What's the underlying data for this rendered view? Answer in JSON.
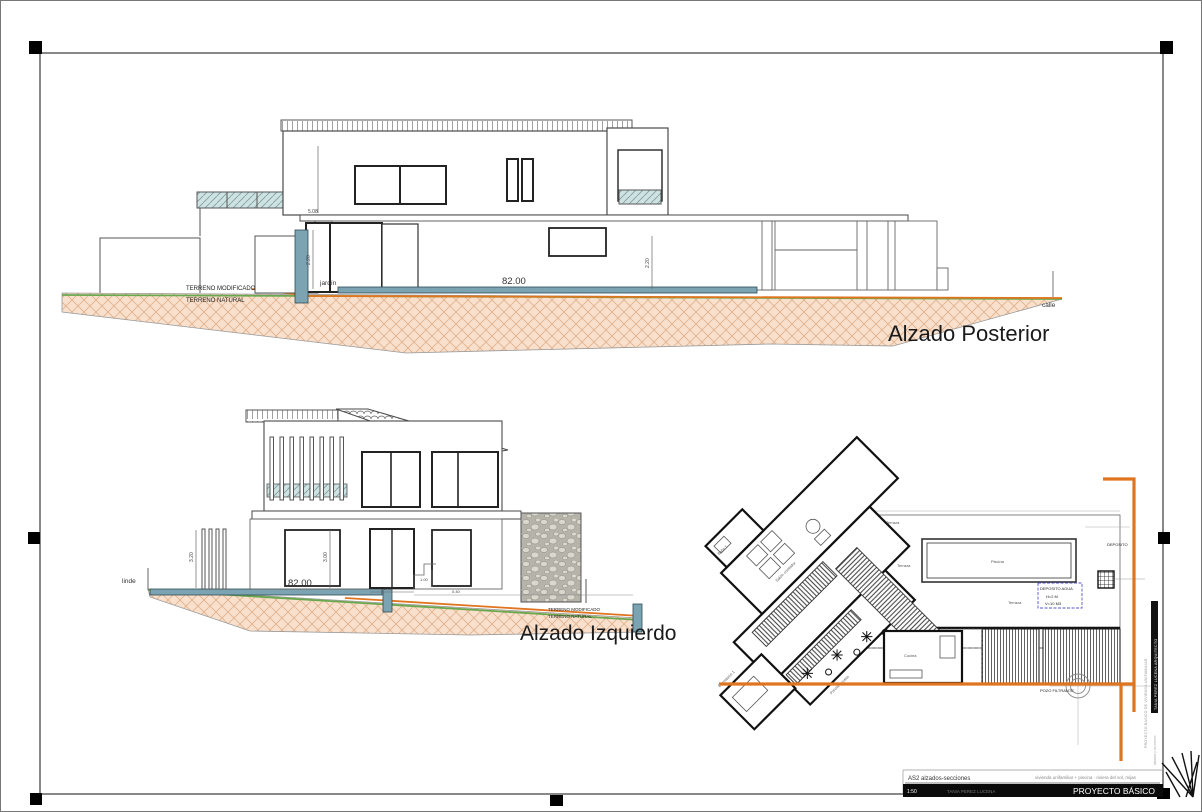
{
  "sheet": {
    "code": "AS2 alzados-secciones",
    "scale": "1:50",
    "author": "TANIA PEREZ LUCENA",
    "phase": "PROYECTO BÁSICO",
    "small_print": "vivienda unifamiliar + piscina · riviera del sol, mijas",
    "side_black": "TANIA PEREZ LUCENA ARQUITECTO",
    "side_gray": "PROYECTO BASICO DE VIVIENDA UNIFAMILIAR",
    "side_gray2": "alzados y secciones"
  },
  "posterior": {
    "title": "Alzado Posterior",
    "terreno_modificado": "TERRENO MODIFICADO",
    "terreno_natural": "TERRENO NATURAL",
    "jardin": "jardín",
    "calle": "calle",
    "dim_width": "82.00",
    "dim_door": "2.20",
    "dim_right": "2.20",
    "dim_top": "5.08"
  },
  "izquierdo": {
    "title": "Alzado Izquierdo",
    "linde": "linde",
    "dim_width": "82.00",
    "dim_fence": "3.20",
    "dim_floor": "3.00",
    "dim_a": "2.71",
    "dim_b": "1.00",
    "dim_c": "0.40",
    "terreno_modificado": "TERRENO MODIFICADO",
    "terreno_natural": "TERRENO NATURAL"
  },
  "plan": {
    "piscina": "Piscina",
    "terraza": "Terraza",
    "deposito_agua": "DEPOSITO AGUA",
    "deposito_h": "H=2 M",
    "deposito_v": "V=10 M3",
    "deposito": "DEPOSITO",
    "pozo": "POZO FILTRANTE",
    "cocina": "Cocina",
    "salon": "Salón comedor",
    "dormitorio": "Dormitorio 1",
    "bano": "Baño 1",
    "porche": "Porche acceso"
  },
  "colors": {
    "terrain_fill": "#f9e0cd",
    "terrain_hatch": "#e0b18a",
    "line_natural": "#6aa84f",
    "line_modified": "#e0751f",
    "boundary_orange": "#e0751f",
    "slab_teal": "#7ba3b2",
    "text_blue": "#5555cc",
    "text_green": "#7fb763",
    "frame": "#444444"
  }
}
